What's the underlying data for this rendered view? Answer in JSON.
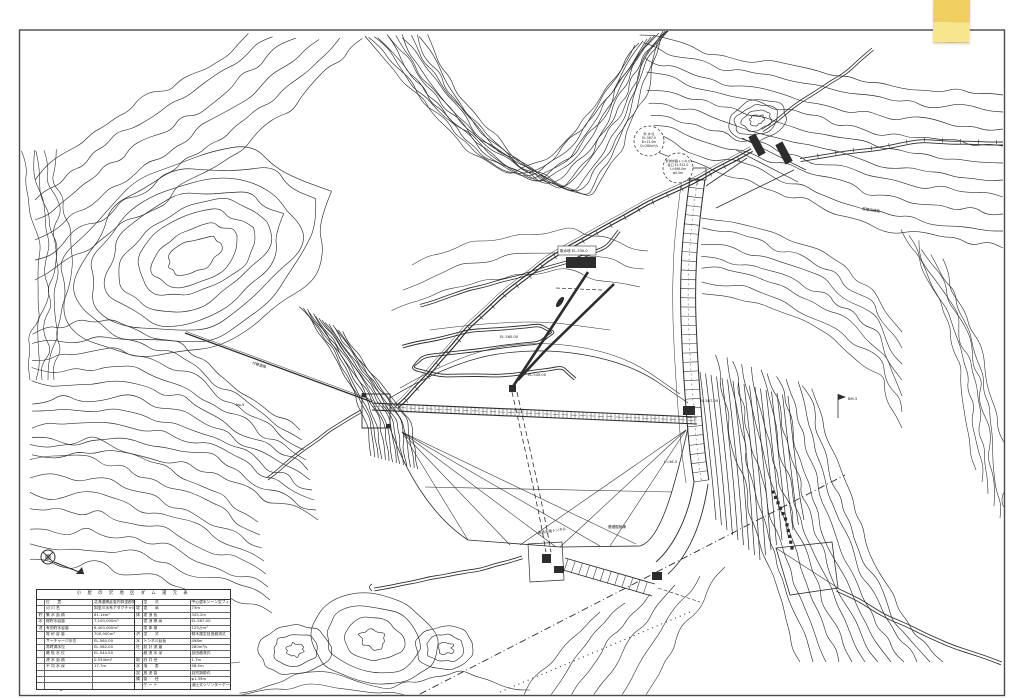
{
  "colors": {
    "paper": "#ffffff",
    "line": "#2d2d2d",
    "border": "#4a4a4a",
    "tape_top": "#efcf60",
    "tape_bottom": "#f8e68d",
    "tape_edge": "#d9b84e"
  },
  "table": {
    "title": "小 屋 の 沢 地 区 ダ ム 諸 元 表",
    "left_rows": [
      {
        "g": "",
        "l": "位　　置",
        "v": "北海道網走管内斜里郡斜里町"
      },
      {
        "g": "",
        "l": "河 川 名",
        "v": "斜里川水系アタクチャ川"
      },
      {
        "g": "貯",
        "l": "集 水 面 積",
        "v": "81.1km²"
      },
      {
        "g": "水",
        "l": "総貯水容量",
        "v": "7,100,000m³"
      },
      {
        "g": "池",
        "l": "有効貯水容量",
        "v": "6,400,000m³"
      },
      {
        "g": "",
        "l": "堆 砂 容 量",
        "v": "700,000m³"
      },
      {
        "g": "",
        "l": "サーチャージ水位",
        "v": "EL.564.00"
      },
      {
        "g": "",
        "l": "常時満水位",
        "v": "EL.562.00"
      },
      {
        "g": "",
        "l": "最 低 水 位",
        "v": "EL.544.50"
      },
      {
        "g": "",
        "l": "湛 水 面 積",
        "v": "0.534km²"
      },
      {
        "g": "",
        "l": "平 均 水 深",
        "v": "17.7m"
      },
      {
        "g": "",
        "l": "",
        "v": ""
      },
      {
        "g": "",
        "l": "",
        "v": ""
      },
      {
        "g": "",
        "l": "",
        "v": ""
      }
    ],
    "right_rows": [
      {
        "g": "",
        "l": "型　　式",
        "v": "中心遮水ゾーン型フィルダム"
      },
      {
        "g": "堤",
        "l": "堤　　高",
        "v": "73m"
      },
      {
        "g": "体",
        "l": "堤 頂 長",
        "v": "345.2m"
      },
      {
        "g": "",
        "l": "堤 頂 標 高",
        "v": "EL.567.00"
      },
      {
        "g": "",
        "l": "堤 体 積",
        "v": "125万m³"
      },
      {
        "g": "洪",
        "l": "型　　式",
        "v": "側水路型自由越流式"
      },
      {
        "g": "水",
        "l": "トンネル延長",
        "v": "498m"
      },
      {
        "g": "吐",
        "l": "設 計 流 量",
        "v": "280m³/s"
      },
      {
        "g": "",
        "l": "越 流 水 深",
        "v": "自由越流式"
      },
      {
        "g": "取",
        "l": "呑 口 径",
        "v": "1.7m"
      },
      {
        "g": "水",
        "l": "落　　差",
        "v": "58.5m"
      },
      {
        "g": "設",
        "l": "放 流 管",
        "v": "自然調節式"
      },
      {
        "g": "備",
        "l": "管　　径",
        "v": "φ1.35m"
      },
      {
        "g": "",
        "l": "ゲ ー ト",
        "v": "油圧式シリンダーゲート"
      }
    ]
  },
  "labels": {
    "t1": "取水塔 EL.530.0",
    "t2": "EL.560.00",
    "t3": "EL.545.00",
    "t4": "EL.567.00",
    "t5": "付替道路",
    "t6": "No.5",
    "t7": "BM.3",
    "t8": "管理用道路",
    "t9": "基礎掘削線",
    "t10": "仮排水路トンネル",
    "t11": "L=36.3"
  },
  "callouts": [
    {
      "lines": [
        "洪 水 吐",
        "EL.567.0",
        "B=12.0m",
        "Q=280m³/s"
      ]
    },
    {
      "lines": [
        "仮排水路トンネル",
        "呑口 EL.512.0",
        "L=498.0m",
        "φ4.5m"
      ]
    }
  ]
}
